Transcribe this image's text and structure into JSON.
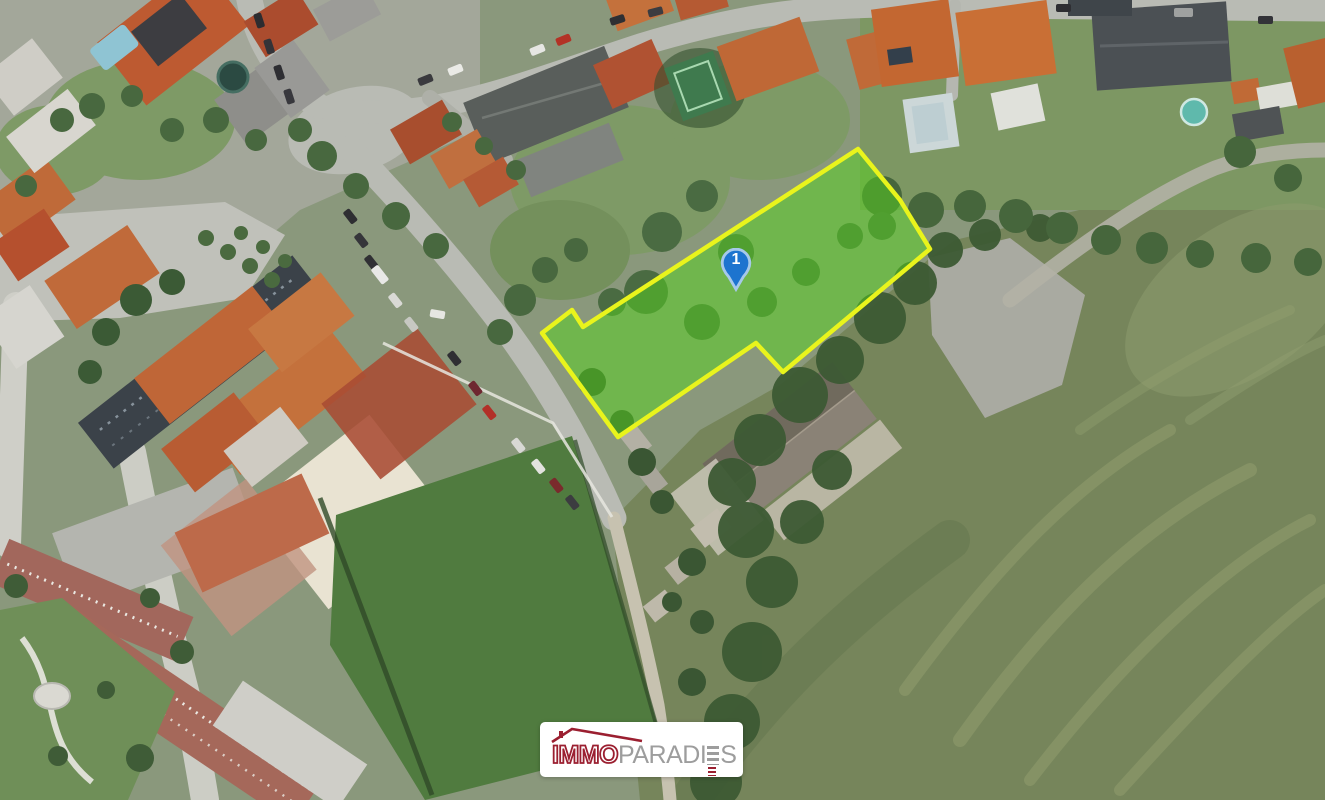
{
  "map": {
    "marker": {
      "label": "1"
    },
    "watermark": {
      "brand_immo": "IMMO",
      "brand_paradi": "PARADI",
      "brand_s": "S",
      "brand_full": "IMMOPARADIES"
    }
  },
  "icons": {
    "marker_pin": "map-pin-teardrop",
    "logo_roof": "house-roof-outline",
    "stylized_e": "stacked-bars-letter-e"
  },
  "theme": {
    "parcel-fill": "#55d41e",
    "parcel-stroke": "#e9f41c",
    "marker-fill": "#1d74cf",
    "marker-ring": "#a6c9ea",
    "marker-num": "#ffffff",
    "logo-red": "#9b1f30",
    "logo-gray": "#9d9d9d",
    "logo-bg": "#ffffff"
  }
}
